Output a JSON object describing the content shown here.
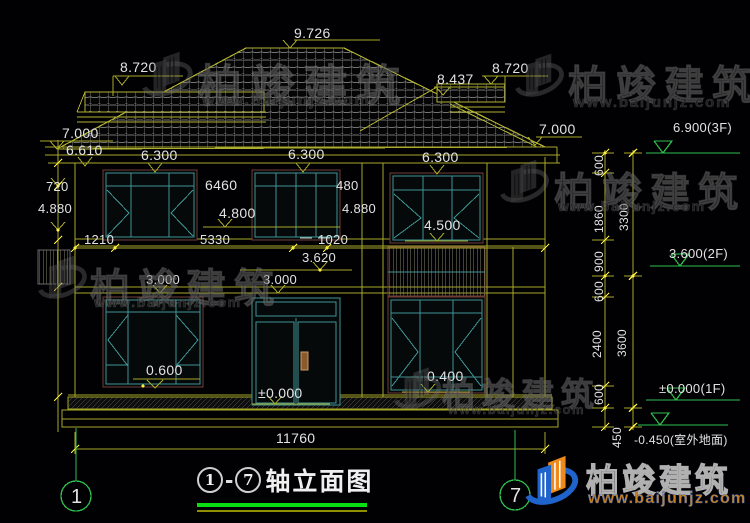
{
  "drawing": {
    "title": {
      "axis_from": "1",
      "axis_to": "7",
      "dash": "-",
      "text": "轴立面图"
    },
    "axis_bubbles": {
      "left": "1",
      "right": "7"
    }
  },
  "watermark": {
    "name": "柏竣建筑",
    "url": "www.baijunjz.com"
  },
  "brand": {
    "name": "柏竣建筑",
    "url": "www.baijunjz.com"
  },
  "colors": {
    "background": "#010104",
    "dim_line": "#a8a828",
    "tick": "#ffef3f",
    "text": "#e2e2e2",
    "level_green": "#2fbf4f",
    "window_teal": "#3e9494",
    "frame_maroon": "#6e3c34",
    "title_underline": "#0ade12",
    "logo_blue": "#1f63cc",
    "logo_orange": "#ef8a1a"
  },
  "labels": [
    {
      "t": "9.726",
      "x": 294,
      "y": 26
    },
    {
      "t": "8.720",
      "x": 120,
      "y": 60
    },
    {
      "t": "8.437",
      "x": 437,
      "y": 72
    },
    {
      "t": "8.720",
      "x": 492,
      "y": 61
    },
    {
      "t": "7.000",
      "x": 62,
      "y": 126
    },
    {
      "t": "6.610",
      "x": 66,
      "y": 143
    },
    {
      "t": "7.000",
      "x": 539,
      "y": 122
    },
    {
      "t": "6.300",
      "x": 141,
      "y": 148
    },
    {
      "t": "6.300",
      "x": 288,
      "y": 147
    },
    {
      "t": "6.300",
      "x": 422,
      "y": 150
    },
    {
      "t": "720",
      "x": 46,
      "y": 180,
      "fs": 13
    },
    {
      "t": "4.880",
      "x": 38,
      "y": 202,
      "fs": 13
    },
    {
      "t": "6460",
      "x": 205,
      "y": 178
    },
    {
      "t": "4.800",
      "x": 219,
      "y": 206
    },
    {
      "t": "480",
      "x": 336,
      "y": 179,
      "fs": 13
    },
    {
      "t": "4.880",
      "x": 342,
      "y": 202,
      "fs": 13
    },
    {
      "t": "4.500",
      "x": 424,
      "y": 218
    },
    {
      "t": "1210",
      "x": 84,
      "y": 233,
      "fs": 13
    },
    {
      "t": "5330",
      "x": 200,
      "y": 233,
      "fs": 13
    },
    {
      "t": "1020",
      "x": 318,
      "y": 233,
      "fs": 13
    },
    {
      "t": "3.620",
      "x": 302,
      "y": 251,
      "fs": 13
    },
    {
      "t": "3.000",
      "x": 146,
      "y": 273,
      "fs": 13
    },
    {
      "t": "3.000",
      "x": 263,
      "y": 273,
      "fs": 13
    },
    {
      "t": "0.600",
      "x": 146,
      "y": 363
    },
    {
      "t": "±0.000",
      "x": 258,
      "y": 386
    },
    {
      "t": "0.400",
      "x": 427,
      "y": 369
    },
    {
      "t": "11760",
      "x": 276,
      "y": 431
    },
    {
      "t": "6.900(3F)",
      "x": 673,
      "y": 121,
      "fs": 13
    },
    {
      "t": "3.600(2F)",
      "x": 669,
      "y": 247,
      "fs": 13
    },
    {
      "t": "±0.000(1F)",
      "x": 659,
      "y": 382,
      "fs": 13
    },
    {
      "t": "-0.450(室外地面)",
      "x": 634,
      "y": 434,
      "fs": 12
    },
    {
      "t": "600",
      "x": 593,
      "y": 176,
      "r": 1,
      "fs": 12
    },
    {
      "t": "1860",
      "x": 593,
      "y": 233,
      "r": 1,
      "fs": 12
    },
    {
      "t": "900",
      "x": 593,
      "y": 272,
      "r": 1,
      "fs": 12
    },
    {
      "t": "600",
      "x": 593,
      "y": 302,
      "r": 1,
      "fs": 12
    },
    {
      "t": "2400",
      "x": 591,
      "y": 358,
      "r": 1,
      "fs": 12
    },
    {
      "t": "600",
      "x": 593,
      "y": 405,
      "r": 1,
      "fs": 12
    },
    {
      "t": "450",
      "x": 611,
      "y": 448,
      "r": 1,
      "fs": 12
    },
    {
      "t": "3300",
      "x": 618,
      "y": 231,
      "r": 1,
      "fs": 12
    },
    {
      "t": "3600",
      "x": 616,
      "y": 357,
      "r": 1,
      "fs": 12
    }
  ],
  "watermarks": [
    {
      "x": 140,
      "y": 46,
      "logo": 58,
      "ts": 44,
      "us": 16,
      "tx": 58,
      "ty": 4,
      "ux": 62,
      "uy": 46
    },
    {
      "x": 513,
      "y": 48,
      "logo": 56,
      "ts": 40,
      "us": 15,
      "tx": 55,
      "ty": 5,
      "ux": 60,
      "uy": 46
    },
    {
      "x": 36,
      "y": 250,
      "logo": 56,
      "ts": 40,
      "us": 14,
      "tx": 54,
      "ty": 6,
      "ux": 58,
      "uy": 44
    },
    {
      "x": 498,
      "y": 154,
      "logo": 56,
      "ts": 40,
      "us": 14,
      "tx": 56,
      "ty": 6,
      "ux": 60,
      "uy": 44
    },
    {
      "x": 392,
      "y": 362,
      "logo": 54,
      "ts": 33,
      "us": 13,
      "tx": 50,
      "ty": 6,
      "ux": 56,
      "uy": 40
    }
  ]
}
